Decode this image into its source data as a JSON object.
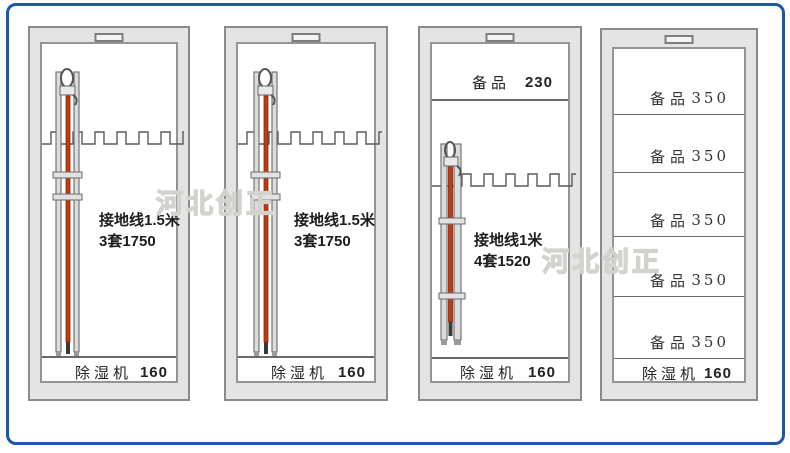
{
  "watermarks": {
    "w1": "河北创正",
    "w2": "河北创正"
  },
  "colors": {
    "frame_blue": "#1a57a5",
    "cabinet_gray": "#e4e4e4",
    "rod_orange": "#c03b12"
  },
  "cabinets": [
    {
      "name": "cabinet-1",
      "main_label_line1": "接地线1.5米",
      "main_label_line2": "3套1750",
      "bottom_label": "除湿机",
      "bottom_value": "160"
    },
    {
      "name": "cabinet-2",
      "main_label_line1": "接地线1.5米",
      "main_label_line2": "3套1750",
      "bottom_label": "除湿机",
      "bottom_value": "160"
    },
    {
      "name": "cabinet-3",
      "top_label": "备品",
      "top_value": "230",
      "main_label_line1": "接地线1米",
      "main_label_line2": "4套1520",
      "bottom_label": "除湿机",
      "bottom_value": "160"
    },
    {
      "name": "cabinet-4",
      "shelves": [
        {
          "label": "备品",
          "value": "350"
        },
        {
          "label": "备品",
          "value": "350"
        },
        {
          "label": "备品",
          "value": "350"
        },
        {
          "label": "备品",
          "value": "350"
        },
        {
          "label": "备品",
          "value": "350"
        }
      ],
      "bottom_label": "除湿机",
      "bottom_value": "160"
    }
  ]
}
